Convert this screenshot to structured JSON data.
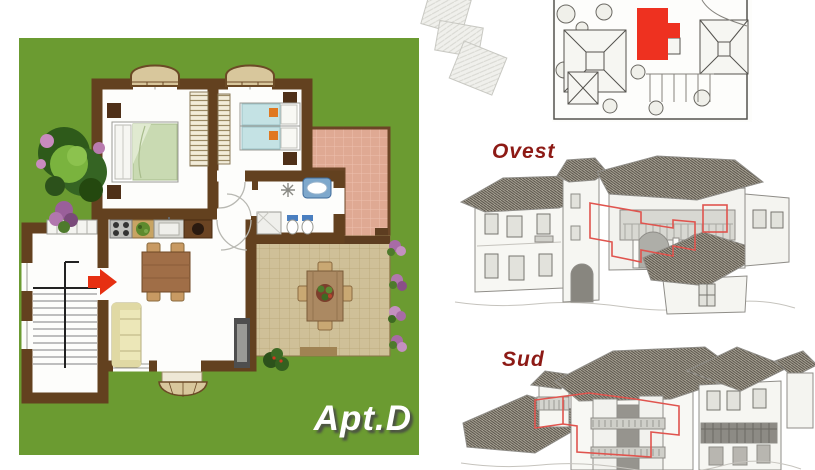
{
  "floorplan": {
    "apartment_label": "Apt.D",
    "colors": {
      "grass": "#6b9b31",
      "wall_brown": "#63411f",
      "room_floor": "#fdfdfb",
      "terrace_pink": "#dfa993",
      "patio_tan": "#cfc098",
      "arrow_red": "#e63012",
      "bed_green": "#c9dab2",
      "bed_blue": "#c4e2e4",
      "sofa_yellow": "#ece7b8",
      "table_brown": "#a06e47",
      "awning_tan": "#d8c79c"
    }
  },
  "site_plan": {
    "highlight_color": "#ee3120"
  },
  "views": {
    "west_label": "Ovest",
    "south_label": "Sud",
    "label_color": "#8d1a15",
    "outline_color": "#e0544e"
  }
}
